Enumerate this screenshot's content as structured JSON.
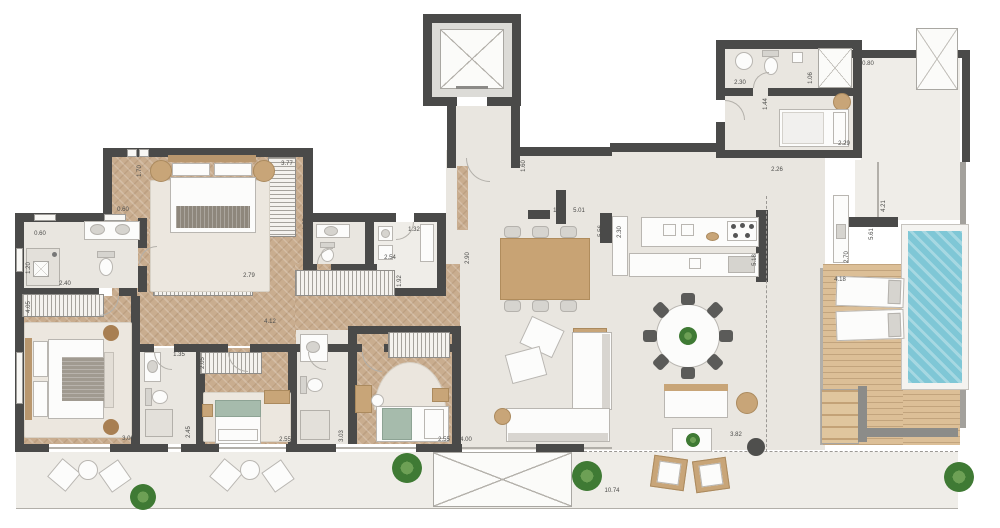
{
  "plan": {
    "title": "apartment-floor-plan",
    "dimension_unit": "m",
    "colors": {
      "wall": "#4a4a49",
      "wood_floor": "#c9ad8f",
      "tile_floor": "#e9e6e0",
      "deck": "#dcbf97",
      "pool_water": "#7fc7d6",
      "terrace": "#efede8",
      "plant_green": "#3f7a34",
      "label_text": "#4b4b49"
    },
    "dimension_labels": [
      {
        "t": "1.70",
        "x": 140,
        "y": 171,
        "v": 1
      },
      {
        "t": "0.60",
        "x": 123,
        "y": 210,
        "v": 0
      },
      {
        "t": "0.60",
        "x": 40,
        "y": 234,
        "v": 0
      },
      {
        "t": "1.70",
        "x": 145,
        "y": 240,
        "v": 1
      },
      {
        "t": "1.20",
        "x": 29,
        "y": 268,
        "v": 1
      },
      {
        "t": "2.40",
        "x": 65,
        "y": 284,
        "v": 0
      },
      {
        "t": "4.05",
        "x": 29,
        "y": 307,
        "v": 1
      },
      {
        "t": "3.77",
        "x": 287,
        "y": 164,
        "v": 0
      },
      {
        "t": "1.35",
        "x": 306,
        "y": 224,
        "v": 1
      },
      {
        "t": "1.32",
        "x": 414,
        "y": 230,
        "v": 0
      },
      {
        "t": "2.54",
        "x": 390,
        "y": 258,
        "v": 0
      },
      {
        "t": "1.92",
        "x": 400,
        "y": 281,
        "v": 1
      },
      {
        "t": "1.60",
        "x": 524,
        "y": 166,
        "v": 1
      },
      {
        "t": "1.20",
        "x": 559,
        "y": 211,
        "v": 0
      },
      {
        "t": "5.01",
        "x": 579,
        "y": 211,
        "v": 0
      },
      {
        "t": "5.56",
        "x": 601,
        "y": 231,
        "v": 1
      },
      {
        "t": "2.30",
        "x": 620,
        "y": 232,
        "v": 1
      },
      {
        "t": "2.90",
        "x": 468,
        "y": 258,
        "v": 1
      },
      {
        "t": "5.18",
        "x": 755,
        "y": 260,
        "v": 1
      },
      {
        "t": "2.70",
        "x": 847,
        "y": 257,
        "v": 1
      },
      {
        "t": "2.30",
        "x": 740,
        "y": 83,
        "v": 0
      },
      {
        "t": "1.06",
        "x": 811,
        "y": 78,
        "v": 1
      },
      {
        "t": "0.80",
        "x": 868,
        "y": 64,
        "v": 0
      },
      {
        "t": "1.44",
        "x": 766,
        "y": 104,
        "v": 1
      },
      {
        "t": "2.29",
        "x": 844,
        "y": 144,
        "v": 0
      },
      {
        "t": "2.26",
        "x": 777,
        "y": 170,
        "v": 0
      },
      {
        "t": "4.21",
        "x": 884,
        "y": 206,
        "v": 1
      },
      {
        "t": "5.61",
        "x": 872,
        "y": 234,
        "v": 1
      },
      {
        "t": "4.18",
        "x": 840,
        "y": 280,
        "v": 0
      },
      {
        "t": "2.55",
        "x": 444,
        "y": 440,
        "v": 0
      },
      {
        "t": "4.00",
        "x": 466,
        "y": 440,
        "v": 0
      },
      {
        "t": "3.03",
        "x": 342,
        "y": 436,
        "v": 1
      },
      {
        "t": "3.06",
        "x": 128,
        "y": 439,
        "v": 0
      },
      {
        "t": "2.45",
        "x": 189,
        "y": 432,
        "v": 1
      },
      {
        "t": "1.35",
        "x": 179,
        "y": 355,
        "v": 0
      },
      {
        "t": "2.05",
        "x": 203,
        "y": 363,
        "v": 1
      },
      {
        "t": "2.55",
        "x": 285,
        "y": 440,
        "v": 0
      },
      {
        "t": "4.12",
        "x": 270,
        "y": 322,
        "v": 0
      },
      {
        "t": "2.79",
        "x": 249,
        "y": 276,
        "v": 0
      },
      {
        "t": "10.74",
        "x": 612,
        "y": 491,
        "v": 0
      },
      {
        "t": "3.82",
        "x": 736,
        "y": 435,
        "v": 0
      }
    ]
  }
}
